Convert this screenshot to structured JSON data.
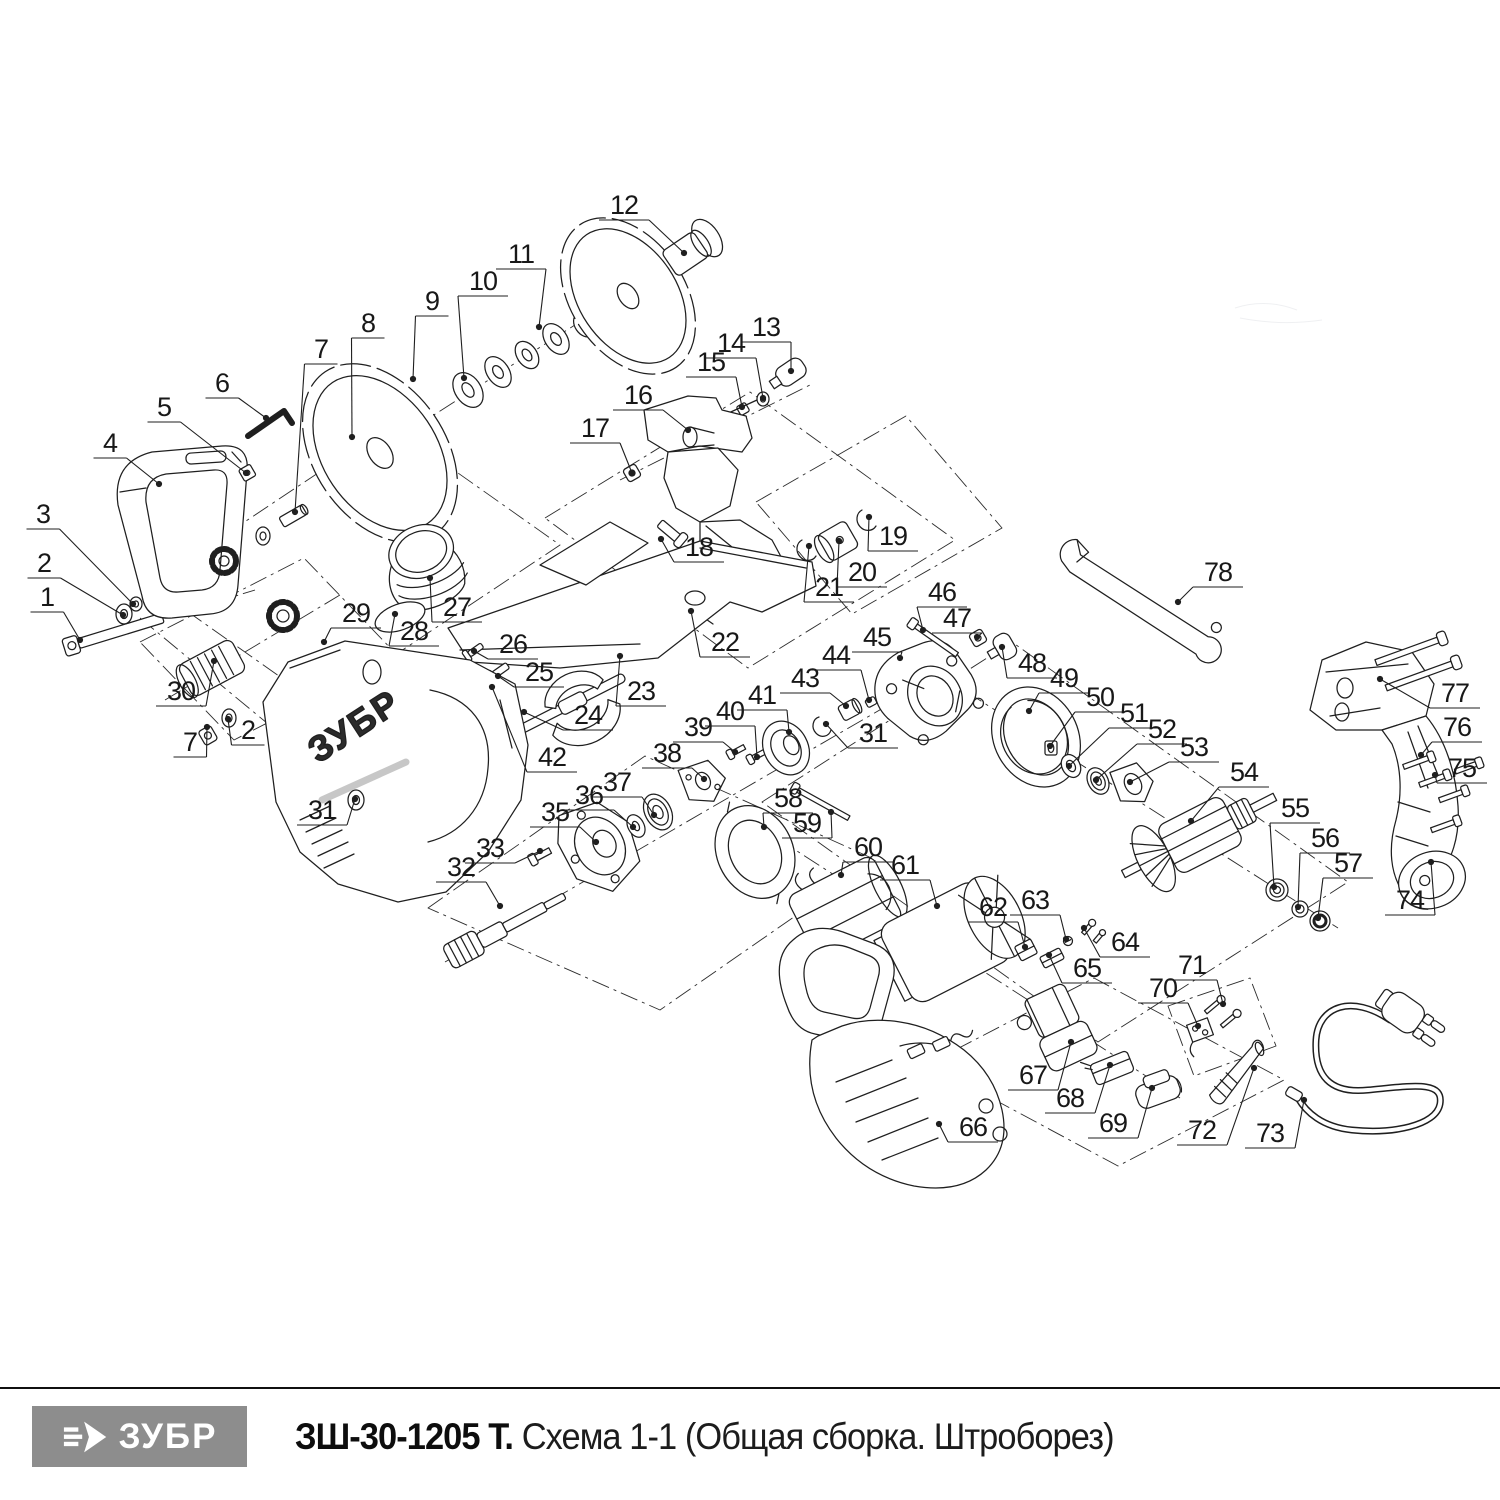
{
  "footer": {
    "logo_text": "ЗУБР",
    "model": "ЗШ-30-1205 Т.",
    "scheme_title": "Схема 1-1 (Общая сборка. Штроборез)"
  },
  "drawing": {
    "brand_on_housing": "ЗУБР",
    "line_color": "#1f1f1f"
  },
  "labels": [
    [
      "1",
      47,
      597,
      80,
      640
    ],
    [
      "2",
      44,
      563,
      123,
      615
    ],
    [
      "3",
      43,
      514,
      133,
      604
    ],
    [
      "4",
      110,
      443,
      159,
      484
    ],
    [
      "5",
      164,
      407,
      246,
      473
    ],
    [
      "6",
      222,
      383,
      266,
      418
    ],
    [
      "7",
      321,
      349,
      295,
      512
    ],
    [
      "8",
      368,
      323,
      352,
      437
    ],
    [
      "9",
      432,
      301,
      413,
      379
    ],
    [
      "10",
      483,
      281,
      464,
      378
    ],
    [
      "11",
      521,
      254,
      539,
      327
    ],
    [
      "12",
      624,
      205,
      684,
      253
    ],
    [
      "13",
      766,
      327,
      791,
      371
    ],
    [
      "14",
      731,
      343,
      763,
      398
    ],
    [
      "15",
      711,
      362,
      742,
      407
    ],
    [
      "16",
      638,
      395,
      688,
      430
    ],
    [
      "17",
      595,
      428,
      632,
      473
    ],
    [
      "18",
      699,
      547,
      661,
      539
    ],
    [
      "19",
      893,
      536,
      869,
      517
    ],
    [
      "20",
      862,
      572,
      839,
      541
    ],
    [
      "21",
      829,
      587,
      809,
      546
    ],
    [
      "22",
      725,
      642,
      691,
      611
    ],
    [
      "23",
      641,
      691,
      620,
      656
    ],
    [
      "24",
      588,
      715,
      524,
      712
    ],
    [
      "25",
      539,
      672,
      498,
      676
    ],
    [
      "26",
      513,
      644,
      474,
      651
    ],
    [
      "27",
      457,
      607,
      430,
      578
    ],
    [
      "28",
      414,
      631,
      395,
      614
    ],
    [
      "29",
      356,
      613,
      324,
      642
    ],
    [
      "30",
      181,
      691,
      214,
      661
    ],
    [
      "31",
      322,
      810,
      355,
      799
    ],
    [
      "2",
      248,
      730,
      228,
      719
    ],
    [
      "7",
      190,
      742,
      207,
      727
    ],
    [
      "32",
      461,
      867,
      500,
      906
    ],
    [
      "33",
      490,
      848,
      540,
      851
    ],
    [
      "35",
      555,
      812,
      596,
      842
    ],
    [
      "36",
      589,
      795,
      633,
      827
    ],
    [
      "37",
      617,
      782,
      654,
      815
    ],
    [
      "38",
      667,
      753,
      704,
      779
    ],
    [
      "39",
      698,
      727,
      735,
      752
    ],
    [
      "40",
      730,
      711,
      757,
      757
    ],
    [
      "41",
      762,
      695,
      789,
      732
    ],
    [
      "42",
      552,
      757,
      492,
      687
    ],
    [
      "43",
      805,
      678,
      846,
      706
    ],
    [
      "44",
      836,
      655,
      869,
      700
    ],
    [
      "31",
      873,
      733,
      826,
      724
    ],
    [
      "45",
      877,
      637,
      900,
      658
    ],
    [
      "46",
      942,
      592,
      923,
      630
    ],
    [
      "47",
      957,
      618,
      977,
      637
    ],
    [
      "48",
      1032,
      663,
      1002,
      647
    ],
    [
      "49",
      1064,
      678,
      1029,
      711
    ],
    [
      "50",
      1100,
      697,
      1050,
      746
    ],
    [
      "51",
      1134,
      713,
      1069,
      766
    ],
    [
      "52",
      1162,
      729,
      1096,
      780
    ],
    [
      "53",
      1194,
      747,
      1130,
      782
    ],
    [
      "54",
      1244,
      772,
      1191,
      821
    ],
    [
      "55",
      1295,
      808,
      1274,
      887
    ],
    [
      "56",
      1325,
      838,
      1298,
      907
    ],
    [
      "57",
      1348,
      863,
      1318,
      918
    ],
    [
      "58",
      788,
      798,
      764,
      827
    ],
    [
      "59",
      807,
      823,
      831,
      812
    ],
    [
      "60",
      868,
      847,
      841,
      875
    ],
    [
      "61",
      905,
      865,
      937,
      906
    ],
    [
      "62",
      993,
      907,
      1025,
      947
    ],
    [
      "63",
      1035,
      900,
      1066,
      939
    ],
    [
      "64",
      1125,
      942,
      1084,
      928
    ],
    [
      "65",
      1087,
      968,
      1049,
      955
    ],
    [
      "66",
      973,
      1127,
      939,
      1124
    ],
    [
      "67",
      1033,
      1075,
      1071,
      1042
    ],
    [
      "68",
      1070,
      1098,
      1110,
      1065
    ],
    [
      "69",
      1113,
      1123,
      1152,
      1088
    ],
    [
      "70",
      1163,
      988,
      1198,
      1026
    ],
    [
      "71",
      1192,
      965,
      1223,
      1004
    ],
    [
      "72",
      1202,
      1130,
      1254,
      1068
    ],
    [
      "73",
      1270,
      1133,
      1304,
      1100
    ],
    [
      "74",
      1410,
      900,
      1431,
      862
    ],
    [
      "75",
      1462,
      768,
      1435,
      775
    ],
    [
      "76",
      1457,
      727,
      1421,
      755
    ],
    [
      "77",
      1455,
      693,
      1380,
      679
    ],
    [
      "78",
      1218,
      572,
      1178,
      602
    ]
  ]
}
